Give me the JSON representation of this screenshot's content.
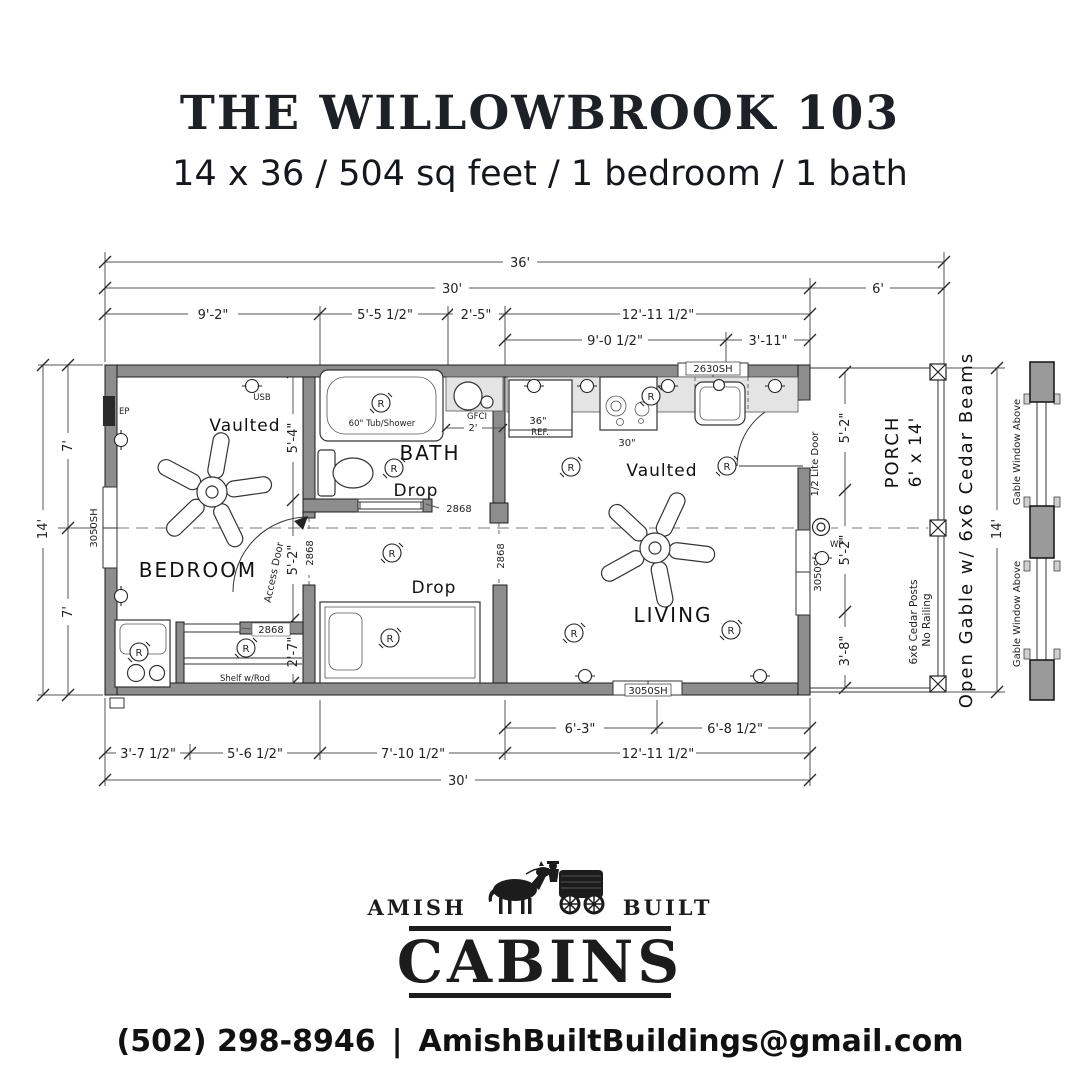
{
  "header": {
    "title": "THE WILLOWBROOK 103",
    "subtitle": "14 x 36 / 504 sq feet / 1 bedroom / 1 bath"
  },
  "plan": {
    "rooms": {
      "bedroom": "BEDROOM",
      "bath": "BATH",
      "living": "LIVING",
      "porch": "PORCH",
      "porch_size": "6' x 14'"
    },
    "ceiling": {
      "vaulted": "Vaulted",
      "drop": "Drop"
    },
    "symbols": {
      "r": "R"
    },
    "fixtures": {
      "tub": "60\" Tub/Shower",
      "fridge_size": "36\"",
      "fridge": "REF.",
      "range_size": "30\"",
      "sink_gfci": "GFCI",
      "sink_width": "2'",
      "shelf": "Shelf w/Rod"
    },
    "electrical": {
      "ep": "EP",
      "usb": "USB",
      "wp": "WP"
    },
    "doors": {
      "access": "Access Door",
      "half_lite": "1/2 Lite Door",
      "size_2868": "2868"
    },
    "windows": {
      "w3050": "3050SH",
      "w2630": "2630SH",
      "gable_above": "Gable Window Above"
    },
    "porch_notes": {
      "open_gable": "Open Gable w/ 6x6 Cedar Beams",
      "posts": "6x6 Cedar Posts",
      "railing": "No Railing"
    },
    "dims": {
      "overall": "36'",
      "main": "30'",
      "porch": "6'",
      "top": [
        "9'-2\"",
        "5'-5 1/2\"",
        "2'-5\"",
        "12'-11 1/2\""
      ],
      "top_sub": [
        "9'-0 1/2\"",
        "3'-11\""
      ],
      "bottom_sub": [
        "6'-3\"",
        "6'-8 1/2\""
      ],
      "bottom": [
        "3'-7 1/2\"",
        "5'-6 1/2\"",
        "7'-10 1/2\"",
        "12'-11 1/2\""
      ],
      "bottom_total": "30'",
      "left_total": "14'",
      "left_top": "7'",
      "left_bottom": "7'",
      "right_total": "14'",
      "right_inner": [
        "5'-2\"",
        "5'-2\"",
        "3'-8\""
      ],
      "mid_inner": [
        "5'-4\"",
        "5'-2\"",
        "2'-7\""
      ]
    }
  },
  "logo": {
    "amish": "AMISH",
    "built": "BUILT",
    "cabins": "CABINS"
  },
  "contact": {
    "phone": "(502) 298-8946",
    "divider": "|",
    "email": "AmishBuiltBuildings@gmail.com"
  }
}
